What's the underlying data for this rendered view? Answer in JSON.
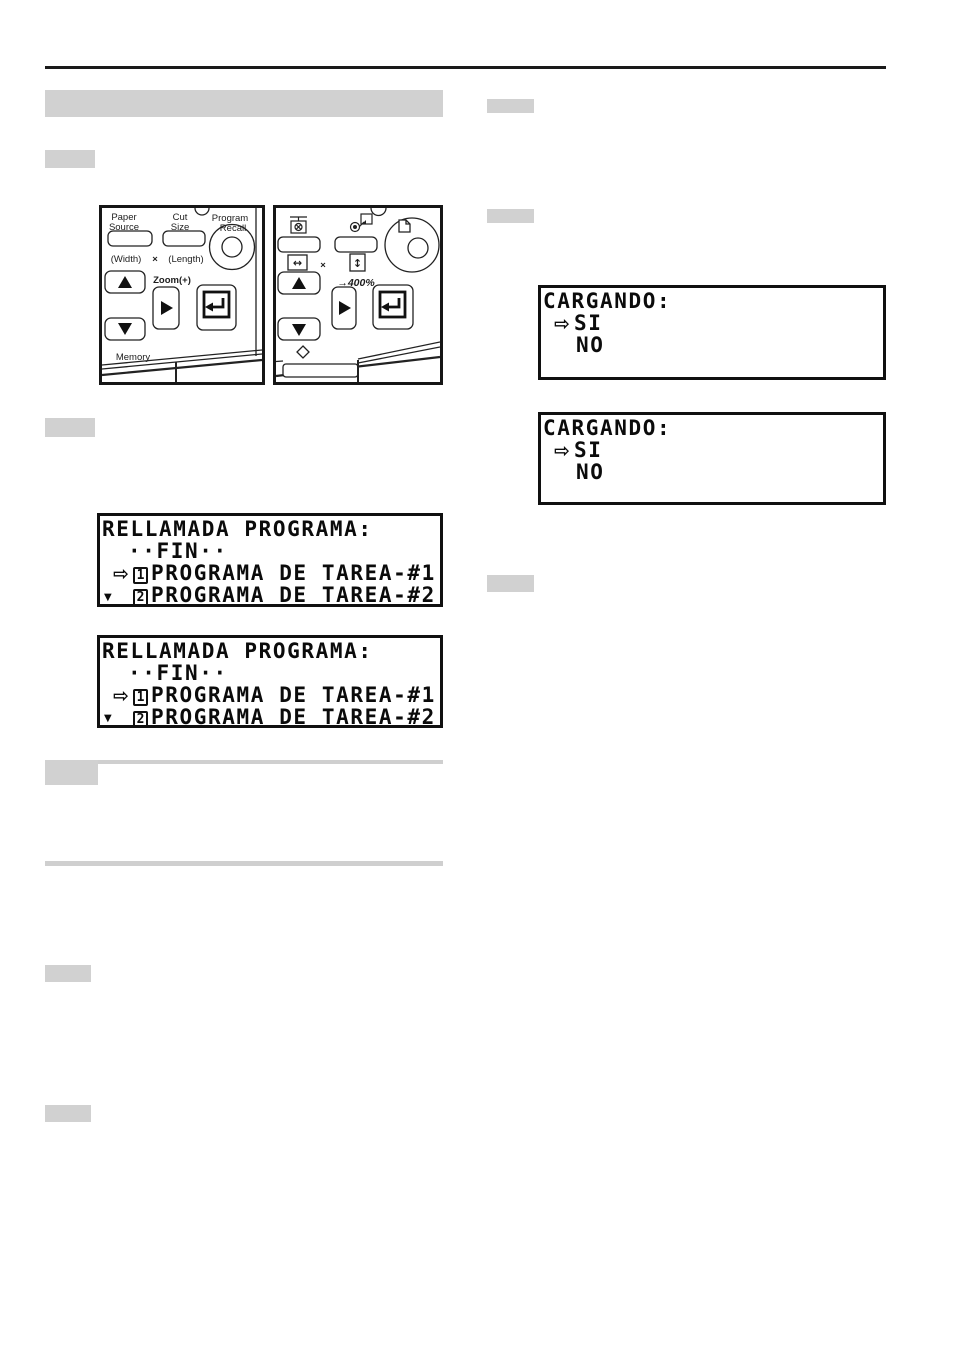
{
  "colors": {
    "badge_gray": "#d1d1d1",
    "rule_black": "#1a1a1a",
    "lcd_text": "#0b0b0b"
  },
  "panel_left": {
    "labels": {
      "paper1": "Paper",
      "paper2": "Source",
      "cut1": "Cut",
      "cut2": "Size",
      "prog1": "Program",
      "prog2": "Recall",
      "width": "(Width)",
      "times": "×",
      "length": "(Length)",
      "zoom": "Zoom(+)",
      "memory": "Memory"
    }
  },
  "panel_right": {
    "labels": {
      "times": "×",
      "max_zoom": "→400%",
      "width_icon": "↔",
      "length_icon": "↕"
    }
  },
  "lcd_program_recall": {
    "title": "RELLAMADA PROGRAMA:",
    "end_item": "··FIN··",
    "cursor": "⇨",
    "item1_num": "1",
    "item1_label": "PROGRAMA DE TAREA-#1",
    "item2_num": "2",
    "item2_label": "PROGRAMA DE TAREA-#2",
    "scroll_indicator": "▼"
  },
  "lcd_loading": {
    "title": "CARGANDO:",
    "cursor": "⇨",
    "option_yes": "SI",
    "option_no": "NO"
  }
}
